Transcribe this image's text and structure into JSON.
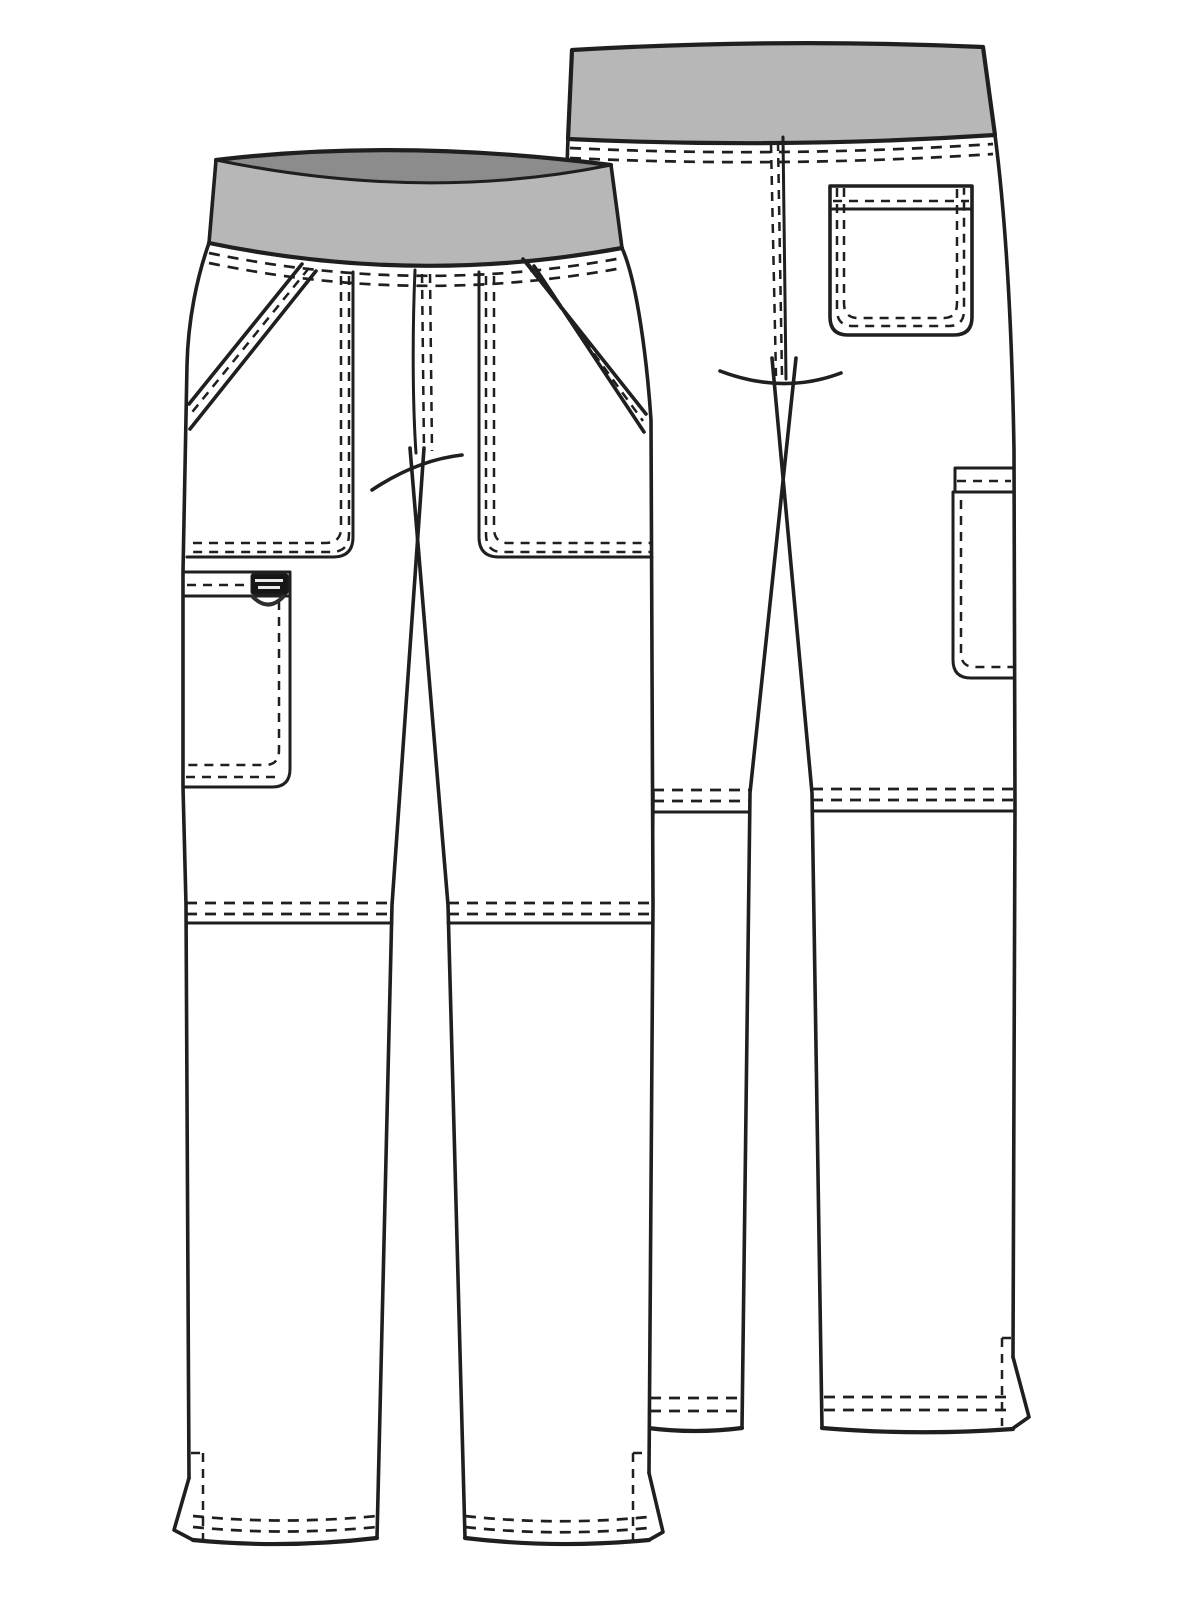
{
  "page": {
    "width_px": 1200,
    "height_px": 1600,
    "background": "#ffffff"
  },
  "diagram": {
    "kind": "garment-technical-flat-sketch",
    "subject": "cargo scrub pants with knit waistband, front and back views",
    "views": [
      {
        "name": "front-view",
        "position": "left",
        "parts": [
          "elastic-knit-waistband",
          "center-front-rise-seam",
          "angled-slash-pocket-left",
          "angled-slash-pocket-right",
          "side-cargo-pocket-with-brand-label",
          "knee-seams",
          "hem-side-vents"
        ]
      },
      {
        "name": "back-view",
        "position": "right",
        "parts": [
          "elastic-knit-waistband",
          "center-back-seam",
          "back-patch-pocket",
          "side-cargo-pocket",
          "knee-seams",
          "hem-side-vent"
        ]
      }
    ],
    "brand_label": {
      "present": true,
      "text": ""
    },
    "colors": {
      "page_bg": "#ffffff",
      "fabric": "#ffffff",
      "outline": "#1f1f1f",
      "waistband": "#b7b7b7",
      "waistband_inner": "#8c8c8c",
      "label_bg": "#161616",
      "label_tick": "#e9e9e9",
      "shadow_arc": "#2e2e2e"
    }
  }
}
